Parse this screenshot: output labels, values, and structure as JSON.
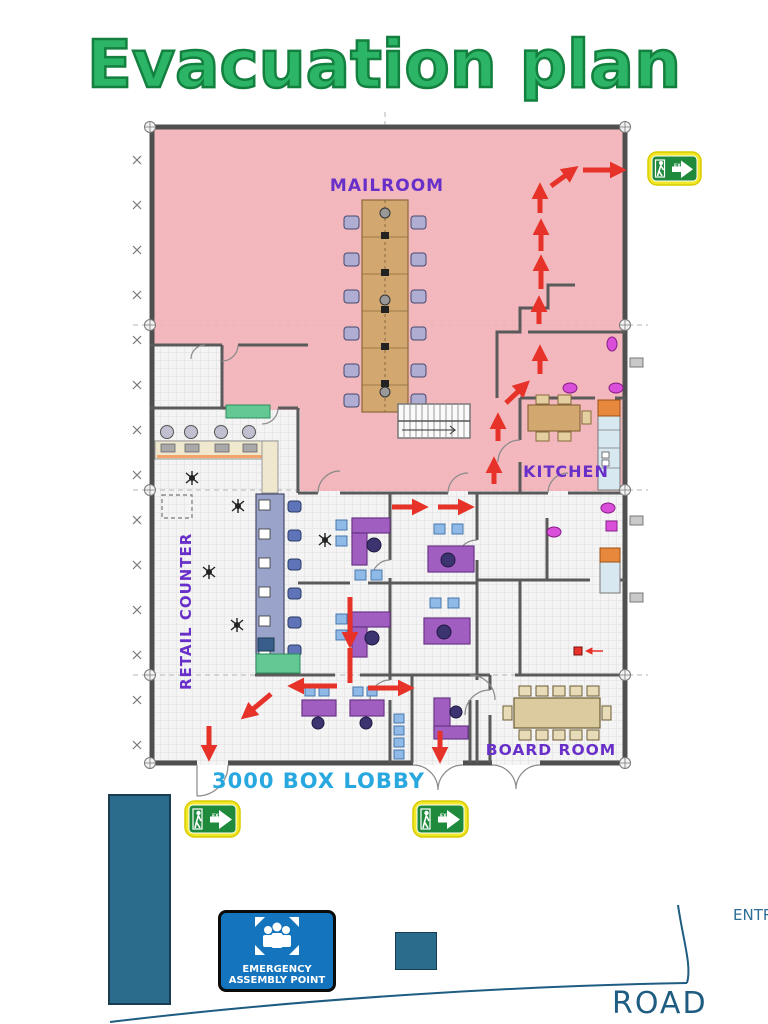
{
  "title": "Evacuation plan",
  "plan": {
    "labels": {
      "mailroom": "MAILROOM",
      "kitchen": "KITCHEN",
      "retail_counter": "RETAIL COUNTER",
      "board_room": "BOARD ROOM",
      "lobby": "3000 BOX LOBBY"
    }
  },
  "signs": {
    "exit_label": "EXIT",
    "assembly": {
      "line1": "EMERGENCY",
      "line2": "ASSEMBLY POINT"
    }
  },
  "site": {
    "road": "ROAD",
    "entrance": "ENTR"
  },
  "colors": {
    "title_green": "#2CB567",
    "title_outline": "#14803F",
    "route_red": "#E63228",
    "room_label_purple": "#6930C9",
    "lobby_label_cyan": "#29A8E0",
    "exit_sign_green": "#1F8A3C",
    "exit_sign_yellow": "#F2E82A",
    "assembly_blue": "#1474BE",
    "site_teal": "#2B6B8C",
    "road_text_blue": "#1F5C82",
    "evacuation_overlay_pink": "#F2AFB5"
  }
}
